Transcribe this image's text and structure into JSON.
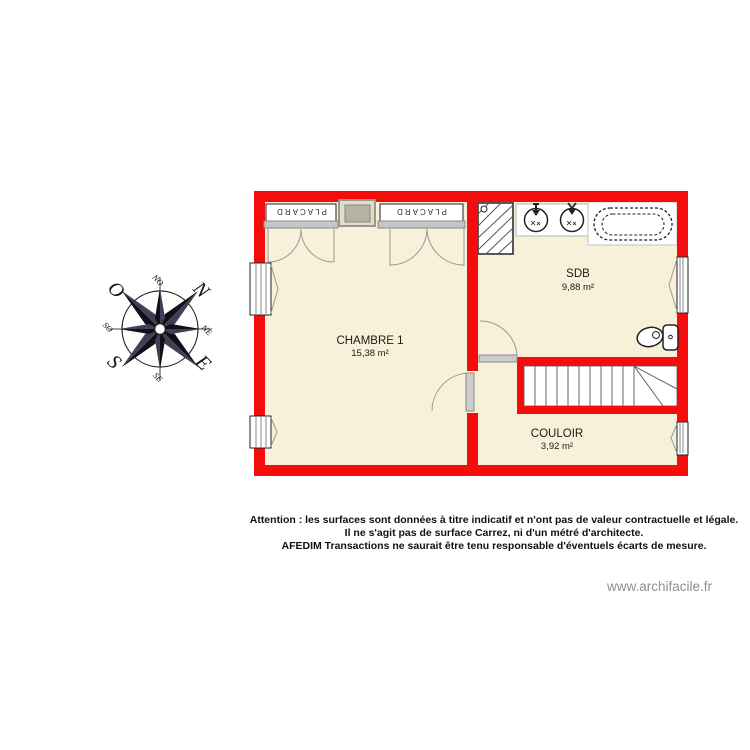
{
  "watermark": "www.archifacile.fr",
  "compass": {
    "n": "N",
    "e": "E",
    "s": "S",
    "o": "O",
    "no": "NO",
    "ne": "NE",
    "se": "SE",
    "so": "SO"
  },
  "rooms": {
    "chambre1": {
      "name": "CHAMBRE 1",
      "area": "15,38 m²"
    },
    "sdb": {
      "name": "SDB",
      "area": "9,88 m²"
    },
    "couloir": {
      "name": "COULOIR",
      "area": "3,92 m²"
    }
  },
  "fixtures": {
    "placard": "PLACARD"
  },
  "disclaimer": {
    "line1": "Attention : les surfaces sont données à titre indicatif et n'ont pas de valeur contractuelle et légale.",
    "line2": "Il ne s'agit pas de surface Carrez, ni d'un métré d'architecte.",
    "line3": "AFEDIM Transactions ne saurait être tenu responsable d'éventuels écarts de mesure."
  },
  "colors": {
    "wall": "#f50c0c",
    "floor": "#f7f1da",
    "watermark": "#8f8f8f"
  }
}
